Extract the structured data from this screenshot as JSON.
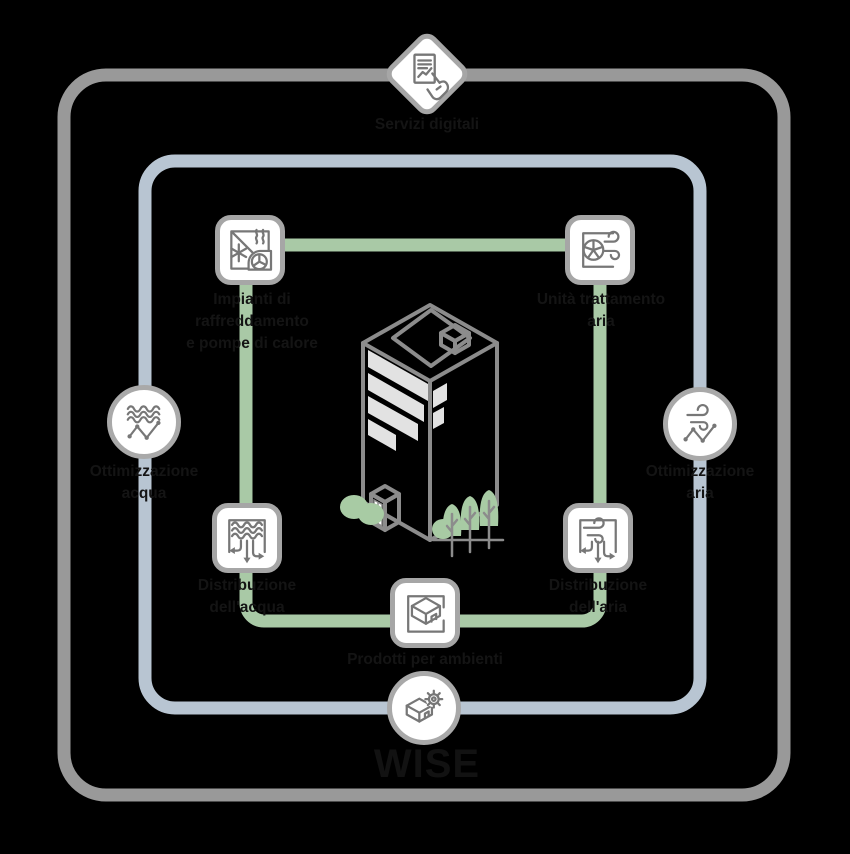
{
  "title": "WISE",
  "colors": {
    "background": "#000000",
    "outer_ring": "#999999",
    "inner_ring": "#b8c5d2",
    "flow_ring": "#a9c9a6",
    "node_border": "#a6a6a6",
    "node_background": "#ffffff",
    "glyph": "#777777",
    "label_text": "#141414",
    "building_outline": "#8c8c8c",
    "building_windows": "#e2e2e2",
    "greenery": "#a8cba4"
  },
  "icons": {
    "servizi_digitali": "document-report-hand-icon",
    "impianti": "chiller-heat-pump-icon",
    "unita_trattamento": "air-handling-unit-fan-icon",
    "ottimizzazione_acqua": "water-optimization-icon",
    "ottimizzazione_aria": "air-optimization-icon",
    "distribuzione_acqua": "water-distribution-icon",
    "distribuzione_aria": "air-distribution-icon",
    "prodotti_ambienti": "room-box-icon",
    "wise": "room-box-gear-icon",
    "center": "building-illustration"
  },
  "nodes": {
    "servizi_digitali": {
      "label": "Servizi digitali"
    },
    "impianti": {
      "line1": "Impianti di",
      "line2": "raffreddamento",
      "line3": "e pompe di calore"
    },
    "unita_trattamento": {
      "line1": "Unità trattamento",
      "line2": "aria"
    },
    "ottimizzazione_acqua": {
      "line1": "Ottimizzazione",
      "line2": "acqua"
    },
    "ottimizzazione_aria": {
      "line1": "Ottimizzazione",
      "line2": "aria"
    },
    "distribuzione_acqua": {
      "line1": "Distribuzione",
      "line2": "dell'acqua"
    },
    "distribuzione_aria": {
      "line1": "Distribuzione",
      "line2": "dell'aria"
    },
    "prodotti_ambienti": {
      "label": "Prodotti per ambienti"
    },
    "wise": {
      "label": "WISE"
    }
  }
}
